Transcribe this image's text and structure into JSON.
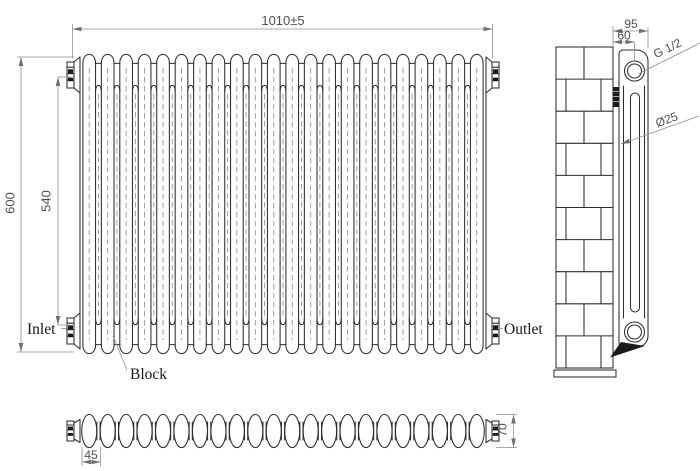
{
  "drawing": {
    "type": "radiator-technical-drawing",
    "sections": 22,
    "brick_courses": 10,
    "line_color": "#2d2d2d",
    "dim_color": "#8f8f8f",
    "text_color": "#4f4f4f"
  },
  "dimensions": {
    "overall_width": "1010±5",
    "overall_height": "600",
    "inner_height": "540",
    "wall_to_face": "95",
    "wall_to_center": "60",
    "section_pitch": "45",
    "depth": "70",
    "tube_diameter": "Ø25",
    "thread_size": "G 1/2"
  },
  "labels": {
    "inlet": "Inlet",
    "outlet": "Outlet",
    "block": "Block"
  }
}
